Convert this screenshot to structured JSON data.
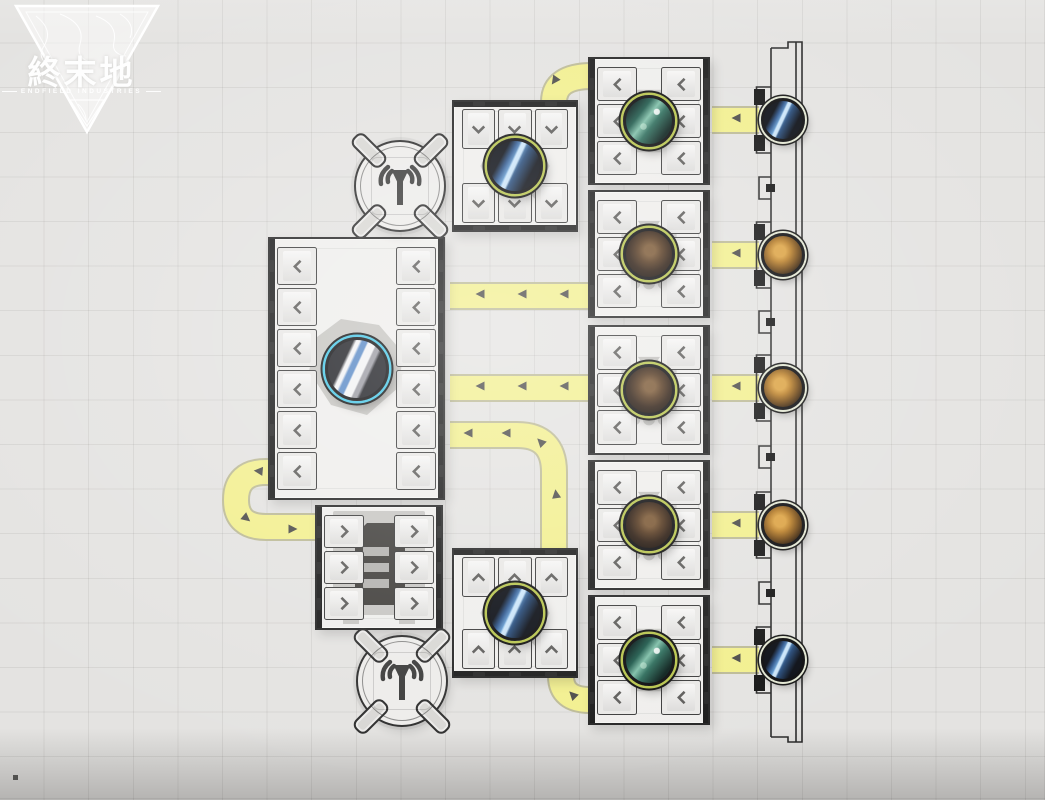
{
  "app": {
    "title": "Endfield Industries Factory Grid View"
  },
  "logo": {
    "title": "終末地",
    "subtitle": "ENDFIELD INDUSTRIES"
  },
  "colors": {
    "background": "#e4e3e1",
    "grid_line": "#c9c8c5",
    "belt_fill": "#f2ef8e",
    "belt_edge": "#bcba96",
    "arrow": "#4c4b49",
    "machine_fill": "#efeeec",
    "machine_border": "#242424",
    "ring_green": "#b7c44c",
    "ring_cyan": "#45c6e6",
    "ring_pale": "#e2e6d2"
  },
  "grid": {
    "cell_px": 44.6
  },
  "factory": {
    "antennas": [
      {
        "id": "signal-relay-north",
        "x": 400,
        "y": 186,
        "r": 46,
        "icon": "broadcast-icon"
      },
      {
        "id": "signal-relay-south",
        "x": 402,
        "y": 681,
        "r": 46,
        "icon": "broadcast-icon"
      }
    ],
    "machines": [
      {
        "id": "ore-deposit-top",
        "x": 452,
        "y": 100,
        "w": 126,
        "h": 132,
        "icon": "magnifier-icon",
        "orb": "blue-crystal",
        "ring": "#b7c44c",
        "orb_size": 56,
        "sides": [
          {
            "side": "top",
            "ports": 3,
            "chevron": "down"
          },
          {
            "side": "bottom",
            "ports": 3,
            "chevron": "down"
          }
        ]
      },
      {
        "id": "processor-north",
        "x": 588,
        "y": 57,
        "w": 122,
        "h": 128,
        "icon": "refine-icon",
        "orb": "teal-crystal",
        "ring": "#b7c44c",
        "orb_size": 52,
        "sides": [
          {
            "side": "left",
            "ports": 3,
            "chevron": "left"
          },
          {
            "side": "right",
            "ports": 3,
            "chevron": "left"
          }
        ]
      },
      {
        "id": "collector-1",
        "x": 588,
        "y": 190,
        "w": 122,
        "h": 128,
        "icon": "hopper-icon",
        "orb": "dark-ore",
        "ring": "#b7c44c",
        "orb_size": 52,
        "sides": [
          {
            "side": "left",
            "ports": 3,
            "chevron": "left"
          },
          {
            "side": "right",
            "ports": 3,
            "chevron": "left"
          }
        ]
      },
      {
        "id": "collector-2",
        "x": 588,
        "y": 325,
        "w": 122,
        "h": 130,
        "icon": "hopper-icon",
        "orb": "dark-ore",
        "ring": "#b7c44c",
        "orb_size": 52,
        "sides": [
          {
            "side": "left",
            "ports": 3,
            "chevron": "left"
          },
          {
            "side": "right",
            "ports": 3,
            "chevron": "left"
          }
        ]
      },
      {
        "id": "collector-3",
        "x": 588,
        "y": 460,
        "w": 122,
        "h": 130,
        "icon": "hopper-icon",
        "orb": "dark-ore",
        "ring": "#b7c44c",
        "orb_size": 52,
        "sides": [
          {
            "side": "left",
            "ports": 3,
            "chevron": "left"
          },
          {
            "side": "right",
            "ports": 3,
            "chevron": "left"
          }
        ]
      },
      {
        "id": "processor-south",
        "x": 588,
        "y": 595,
        "w": 122,
        "h": 130,
        "icon": "refine-icon",
        "orb": "teal-crystal",
        "ring": "#b7c44c",
        "orb_size": 52,
        "sides": [
          {
            "side": "left",
            "ports": 3,
            "chevron": "left"
          },
          {
            "side": "right",
            "ports": 3,
            "chevron": "left"
          }
        ]
      },
      {
        "id": "storage-depot",
        "x": 268,
        "y": 237,
        "w": 177,
        "h": 263,
        "icon": "blob-icon",
        "orb": "white-device",
        "ring": "#45c6e6",
        "orb_size": 64,
        "sides": [
          {
            "side": "left",
            "ports": 6,
            "chevron": "left"
          },
          {
            "side": "right",
            "ports": 6,
            "chevron": "left"
          }
        ]
      },
      {
        "id": "smelter",
        "x": 315,
        "y": 505,
        "w": 128,
        "h": 125,
        "icon": "rack-icon",
        "orb": null,
        "ring": null,
        "orb_size": 0,
        "sides": [
          {
            "side": "left",
            "ports": 3,
            "chevron": "right"
          },
          {
            "side": "right",
            "ports": 3,
            "chevron": "right"
          }
        ]
      },
      {
        "id": "ore-deposit-bottom",
        "x": 452,
        "y": 548,
        "w": 126,
        "h": 130,
        "icon": "magnifier-icon",
        "orb": "blue-crystal",
        "ring": "#b7c44c",
        "orb_size": 56,
        "sides": [
          {
            "side": "top",
            "ports": 3,
            "chevron": "up"
          },
          {
            "side": "bottom",
            "ports": 3,
            "chevron": "up"
          }
        ]
      }
    ],
    "belts": [
      {
        "id": "north-curve",
        "d": "M 592 76 Q 554 76 554 102"
      },
      {
        "id": "row-a",
        "d": "M 590 296 L 450 296"
      },
      {
        "id": "row-b",
        "d": "M 590 388 L 450 388"
      },
      {
        "id": "s-curve",
        "d": "M 554 550 L 554 472 Q 554 435 517 435 L 450 435"
      },
      {
        "id": "u-turn",
        "d": "M 282 472 L 266 472 Q 236 472 236 500 Q 236 527 266 527 L 317 527"
      },
      {
        "id": "south-arc",
        "d": "M 590 700 Q 561 700 561 676"
      },
      {
        "id": "feed-1",
        "d": "M 712 120 L 759 120"
      },
      {
        "id": "feed-2",
        "d": "M 712 255 L 759 255"
      },
      {
        "id": "feed-3",
        "d": "M 712 388 L 759 388"
      },
      {
        "id": "feed-4",
        "d": "M 712 525 L 759 525"
      },
      {
        "id": "feed-5",
        "d": "M 712 660 L 759 660"
      }
    ],
    "arrows": [
      [
        556,
        82,
        125
      ],
      [
        480,
        296,
        180
      ],
      [
        522,
        296,
        180
      ],
      [
        564,
        296,
        180
      ],
      [
        480,
        388,
        180
      ],
      [
        522,
        388,
        180
      ],
      [
        564,
        388,
        180
      ],
      [
        468,
        435,
        180
      ],
      [
        506,
        435,
        180
      ],
      [
        539,
        443,
        225
      ],
      [
        554,
        494,
        262
      ],
      [
        258,
        473,
        185
      ],
      [
        248,
        517,
        40
      ],
      [
        293,
        527,
        0
      ],
      [
        571,
        696,
        225
      ],
      [
        736,
        120,
        180
      ],
      [
        736,
        255,
        180
      ],
      [
        736,
        388,
        180
      ],
      [
        736,
        525,
        180
      ],
      [
        736,
        660,
        180
      ]
    ],
    "wall": {
      "x": 771,
      "x_outer": 802,
      "y_top": 48,
      "y_bottom": 737,
      "node_cx": 783,
      "node_size": 44,
      "node_ring": "#e2e6d2",
      "nodes": [
        {
          "y": 120,
          "resource": "blue-crystal"
        },
        {
          "y": 255,
          "resource": "amber-ore"
        },
        {
          "y": 388,
          "resource": "amber-ore"
        },
        {
          "y": 525,
          "resource": "amber-ore"
        },
        {
          "y": 660,
          "resource": "blue-crystal"
        }
      ],
      "notch_ys": [
        188,
        322,
        457,
        593
      ]
    },
    "marker_dot": {
      "x": 13,
      "y": 775
    }
  }
}
